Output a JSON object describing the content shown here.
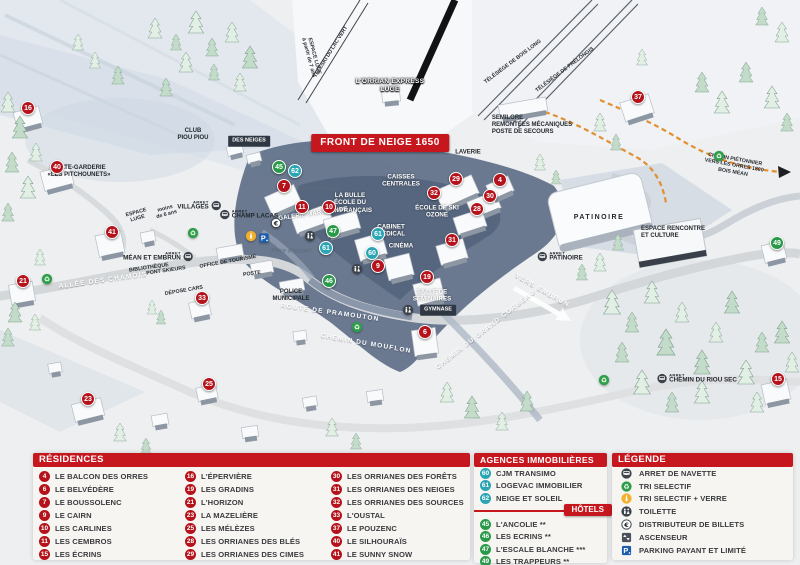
{
  "colors": {
    "red": "#b5121b",
    "teal": "#2ba4b4",
    "green": "#279949",
    "header_red": "#c6171e"
  },
  "map": {
    "labels": [
      {
        "style": "banner",
        "name": "front-de-neige-banner",
        "text": "FRONT DE NEIGE 1650",
        "x": 380,
        "y": 143,
        "rot": 0
      },
      {
        "style": "outline",
        "name": "orrian-express-label",
        "text": "L'ORRIAN EXPRESS\nLUGE",
        "x": 390,
        "y": 86,
        "rot": 0
      },
      {
        "style": "tiny",
        "name": "espace-luge-track-label",
        "text": "ESPACE LUGE\nà partir de 7 ans",
        "x": 311,
        "y": 57,
        "rot": 75
      },
      {
        "style": "tiny",
        "name": "teleski-lac-vert-label",
        "text": "TÉLÉSKI DU LAC VERT",
        "x": 331,
        "y": 52,
        "rot": -58
      },
      {
        "style": "tiny",
        "name": "telesiege-bois-long-label",
        "text": "TÉLÉSIÈGE DE BOIS LONG",
        "x": 513,
        "y": 62,
        "rot": -37
      },
      {
        "style": "tiny",
        "name": "telesiege-prelongis-label",
        "text": "TÉLÉSIÈGE DE PRÉLONGIS",
        "x": 565,
        "y": 70,
        "rot": -37
      },
      {
        "style": "signL",
        "name": "semilore-label",
        "text": "SEMILORE\nREMONTÉES MÉCANIQUES\nPOSTE DE SECOURS",
        "x": 532,
        "y": 126,
        "rot": 0
      },
      {
        "style": "sign",
        "name": "club-piou-piou-label",
        "text": "CLUB\nPIOU PIOU",
        "x": 193,
        "y": 135,
        "rot": 0
      },
      {
        "style": "darkbox",
        "name": "jardin-des-neiges-label",
        "text": "DES NEIGES",
        "x": 249,
        "y": 141,
        "rot": 0
      },
      {
        "style": "sign",
        "name": "halte-garderie-label",
        "text": "HALTE-GARDERIE\n«LES PITCHOUNETS»",
        "x": 79,
        "y": 172,
        "rot": 0
      },
      {
        "style": "tiny",
        "name": "espace-luge-small-label",
        "text": "ESPACE\nLUGE",
        "x": 137,
        "y": 216,
        "rot": -15
      },
      {
        "style": "tiny",
        "name": "moins-6-ans-label",
        "text": "moins\nde 6 ans",
        "x": 166,
        "y": 212,
        "rot": -15
      },
      {
        "style": "place",
        "name": "place-du-festival-label",
        "text": "Place du festival",
        "x": 318,
        "y": 190,
        "rot": 0
      },
      {
        "style": "white",
        "name": "la-bulle-esf-label",
        "text": "LA BULLE\nÉCOLE DU\nSKI FRANÇAIS",
        "x": 350,
        "y": 203,
        "rot": 0
      },
      {
        "style": "white",
        "name": "galerie-marchande-label",
        "text": "GALERIE MARCHANDE",
        "x": 313,
        "y": 214,
        "rot": -8
      },
      {
        "style": "white",
        "name": "caisses-centrales-label",
        "text": "CAISSES\nCENTRALES",
        "x": 401,
        "y": 181,
        "rot": 0
      },
      {
        "style": "white",
        "name": "cabinet-medical-label",
        "text": "CABINET\nMÉDICAL",
        "x": 391,
        "y": 231,
        "rot": 0
      },
      {
        "style": "white",
        "name": "cinema-label",
        "text": "CINÉMA",
        "x": 401,
        "y": 246,
        "rot": 0
      },
      {
        "style": "white",
        "name": "ecole-ski-ozone-label",
        "text": "ÉCOLE DE SKI\nOZONE",
        "x": 437,
        "y": 212,
        "rot": 0
      },
      {
        "style": "sign",
        "name": "laverie-label",
        "text": "LAVERIE",
        "x": 468,
        "y": 153,
        "rot": 0
      },
      {
        "style": "bigsign",
        "name": "patinoire-building-label",
        "text": "PATINOIRE",
        "x": 599,
        "y": 218,
        "rot": 0
      },
      {
        "style": "road",
        "name": "vers-embrun-label",
        "text": "VERS EMBRUN",
        "x": 542,
        "y": 291,
        "rot": 30
      },
      {
        "style": "signL",
        "name": "espace-rencontre-label",
        "text": "ESPACE RENCONTRE\nET CULTURE",
        "x": 673,
        "y": 233,
        "rot": 0
      },
      {
        "style": "tiny",
        "name": "chemin-pietonnier-label",
        "text": "CHEMIN PIÉTONNIER\nVERS LES ORRES 1800\nBOIS MÉAN",
        "x": 734,
        "y": 166,
        "rot": 10
      },
      {
        "style": "road",
        "name": "allee-des-chamois-label",
        "text": "ALLÉE DES CHAMOIS",
        "x": 103,
        "y": 281,
        "rot": -8
      },
      {
        "style": "tiny",
        "name": "pont-skieurs-label",
        "text": "PONT SKIEURS",
        "x": 166,
        "y": 271,
        "rot": -8
      },
      {
        "style": "tiny",
        "name": "office-de-tourisme-label",
        "text": "OFFICE DE TOURISME",
        "x": 228,
        "y": 262,
        "rot": -10
      },
      {
        "style": "tiny",
        "name": "bibliotheque-label",
        "text": "BIBLIOTHÈQUE",
        "x": 149,
        "y": 268,
        "rot": -8
      },
      {
        "style": "tiny",
        "name": "poste-label",
        "text": "POSTE",
        "x": 252,
        "y": 274,
        "rot": -8
      },
      {
        "style": "tiny",
        "name": "depose-cars-label",
        "text": "DÉPOSE CARS",
        "x": 184,
        "y": 291,
        "rot": -10
      },
      {
        "style": "sign",
        "name": "police-municipale-label",
        "text": "POLICE\nMUNICIPALE",
        "x": 291,
        "y": 296,
        "rot": 0
      },
      {
        "style": "place",
        "name": "place-accueil-label",
        "text": "Place d'accueil",
        "x": 291,
        "y": 252,
        "rot": 0
      },
      {
        "style": "road",
        "name": "route-pramouton-label",
        "text": "ROUTE DE PRAMOUTON",
        "x": 330,
        "y": 313,
        "rot": 8
      },
      {
        "style": "road",
        "name": "chemin-mouflon-label",
        "text": "CHEMIN DU MOUFLON",
        "x": 366,
        "y": 344,
        "rot": 10
      },
      {
        "style": "road",
        "name": "chemin-grand-corbeau-label",
        "text": "CHEMIN DU GRAND CORBEAU",
        "x": 486,
        "y": 330,
        "rot": -38
      },
      {
        "style": "white",
        "name": "salle-seminaires-label",
        "text": "SALLE DE\nSÉMINAIRES",
        "x": 432,
        "y": 296,
        "rot": 0
      },
      {
        "style": "darkbox",
        "name": "gymnase-label",
        "text": "GYMNASE",
        "x": 438,
        "y": 310,
        "rot": 0
      }
    ],
    "markers": [
      {
        "n": "16",
        "type": "res",
        "x": 28,
        "y": 108
      },
      {
        "n": "40",
        "type": "res",
        "x": 57,
        "y": 167
      },
      {
        "n": "41",
        "type": "res",
        "x": 112,
        "y": 232
      },
      {
        "n": "21",
        "type": "res",
        "x": 23,
        "y": 281
      },
      {
        "n": "33",
        "type": "res",
        "x": 202,
        "y": 298
      },
      {
        "n": "23",
        "type": "res",
        "x": 88,
        "y": 399
      },
      {
        "n": "25",
        "type": "res",
        "x": 209,
        "y": 384
      },
      {
        "n": "7",
        "type": "res",
        "x": 284,
        "y": 186
      },
      {
        "n": "11",
        "type": "res",
        "x": 302,
        "y": 207
      },
      {
        "n": "10",
        "type": "res",
        "x": 329,
        "y": 207
      },
      {
        "n": "9",
        "type": "res",
        "x": 378,
        "y": 266
      },
      {
        "n": "19",
        "type": "res",
        "x": 427,
        "y": 277
      },
      {
        "n": "6",
        "type": "res",
        "x": 425,
        "y": 332
      },
      {
        "n": "29",
        "type": "res",
        "x": 456,
        "y": 179
      },
      {
        "n": "4",
        "type": "res",
        "x": 500,
        "y": 180
      },
      {
        "n": "32",
        "type": "res",
        "x": 434,
        "y": 193
      },
      {
        "n": "30",
        "type": "res",
        "x": 490,
        "y": 196
      },
      {
        "n": "28",
        "type": "res",
        "x": 477,
        "y": 209
      },
      {
        "n": "31",
        "type": "res",
        "x": 452,
        "y": 240
      },
      {
        "n": "37",
        "type": "res",
        "x": 638,
        "y": 97
      },
      {
        "n": "15",
        "type": "res",
        "x": 778,
        "y": 379
      },
      {
        "n": "62",
        "type": "ag",
        "x": 295,
        "y": 171
      },
      {
        "n": "61",
        "type": "ag",
        "x": 326,
        "y": 248
      },
      {
        "n": "61",
        "type": "ag",
        "x": 378,
        "y": 234
      },
      {
        "n": "60",
        "type": "ag",
        "x": 372,
        "y": 253
      },
      {
        "n": "45",
        "type": "hot",
        "x": 279,
        "y": 167
      },
      {
        "n": "47",
        "type": "hot",
        "x": 333,
        "y": 231
      },
      {
        "n": "46",
        "type": "hot",
        "x": 329,
        "y": 281
      },
      {
        "n": "49",
        "type": "hot",
        "x": 777,
        "y": 243
      }
    ],
    "icons": [
      {
        "type": "recycle",
        "x": 193,
        "y": 233
      },
      {
        "type": "recycle",
        "x": 47,
        "y": 279
      },
      {
        "type": "recycle",
        "x": 357,
        "y": 327
      },
      {
        "type": "recycle",
        "x": 719,
        "y": 156
      },
      {
        "type": "recycle",
        "x": 604,
        "y": 380
      },
      {
        "type": "euro",
        "x": 276,
        "y": 223
      },
      {
        "type": "parking",
        "x": 264,
        "y": 238
      },
      {
        "type": "glass",
        "x": 251,
        "y": 236
      },
      {
        "type": "toilet",
        "x": 310,
        "y": 236
      },
      {
        "type": "toilet",
        "x": 357,
        "y": 269
      },
      {
        "type": "toilet",
        "x": 408,
        "y": 310
      }
    ],
    "bus_stops": [
      {
        "arret": "ARRET",
        "name": "VILLAGES",
        "x": 199,
        "y": 206,
        "icon_side": "right"
      },
      {
        "arret": "ARRET",
        "name": "CHAMP LACAS",
        "x": 249,
        "y": 215,
        "icon_side": "left"
      },
      {
        "arret": "ARRET",
        "name": "MÉAN ET EMBRUN",
        "x": 158,
        "y": 257,
        "icon_side": "right"
      },
      {
        "arret": "ARRET",
        "name": "PATINOIRE",
        "x": 560,
        "y": 257,
        "icon_side": "left"
      },
      {
        "arret": "ARRET",
        "name": "CHEMIN DU RIOU SEC",
        "x": 697,
        "y": 379,
        "icon_side": "left"
      }
    ]
  },
  "legend": {
    "residences": {
      "title": "RÉSIDENCES",
      "columns": [
        [
          {
            "n": "4",
            "label": "LE BALCON DES ORRES"
          },
          {
            "n": "6",
            "label": "LE BELVÉDÈRE"
          },
          {
            "n": "7",
            "label": "LE BOUSSOLENC"
          },
          {
            "n": "9",
            "label": "LE CAIRN"
          },
          {
            "n": "10",
            "label": "LES CARLINES"
          },
          {
            "n": "11",
            "label": "LES CEMBROS"
          },
          {
            "n": "15",
            "label": "LES ÉCRINS"
          }
        ],
        [
          {
            "n": "16",
            "label": "L'ÉPERVIÈRE"
          },
          {
            "n": "19",
            "label": "LES GRADINS"
          },
          {
            "n": "21",
            "label": "L'HORIZON"
          },
          {
            "n": "23",
            "label": "LA MAZELIÈRE"
          },
          {
            "n": "25",
            "label": "LES MÉLÈZES"
          },
          {
            "n": "28",
            "label": "LES ORRIANES DES BLÉS"
          },
          {
            "n": "29",
            "label": "LES ORRIANES DES CIMES"
          }
        ],
        [
          {
            "n": "30",
            "label": "LES ORRIANES DES FORÊTS"
          },
          {
            "n": "31",
            "label": "LES ORRIANES DES NEIGES"
          },
          {
            "n": "32",
            "label": "LES ORRIANES DES SOURCES"
          },
          {
            "n": "33",
            "label": "L'OUSTAL"
          },
          {
            "n": "37",
            "label": "LE POUZENC"
          },
          {
            "n": "40",
            "label": "LE SILHOURAÏS"
          },
          {
            "n": "41",
            "label": "LE SUNNY SNOW"
          }
        ]
      ]
    },
    "agencies": {
      "title": "AGENCES IMMOBILIÈRES",
      "items": [
        {
          "n": "60",
          "label": "CJM TRANSIMO"
        },
        {
          "n": "61",
          "label": "LOGEVAC IMMOBILIER"
        },
        {
          "n": "62",
          "label": "NEIGE ET SOLEIL"
        }
      ]
    },
    "hotels": {
      "title": "HÔTELS",
      "items": [
        {
          "n": "45",
          "label": "L'ANCOLIE **"
        },
        {
          "n": "46",
          "label": "LES ECRINS **"
        },
        {
          "n": "47",
          "label": "L'ESCALE BLANCHE ***"
        },
        {
          "n": "49",
          "label": "LES TRAPPEURS **"
        }
      ]
    },
    "key": {
      "title": "LÉGENDE",
      "items": [
        {
          "icon": "bus",
          "label": "ARRET DE NAVETTE"
        },
        {
          "icon": "recycle",
          "label": "TRI SELECTIF"
        },
        {
          "icon": "glass",
          "label": "TRI SELECTIF + VERRE"
        },
        {
          "icon": "toilet",
          "label": "TOILETTE"
        },
        {
          "icon": "euro",
          "label": "DISTRIBUTEUR DE BILLETS"
        },
        {
          "icon": "elevator",
          "label": "ASCENSEUR"
        },
        {
          "icon": "parking",
          "label": "PARKING PAYANT ET LIMITÉ"
        }
      ]
    }
  }
}
